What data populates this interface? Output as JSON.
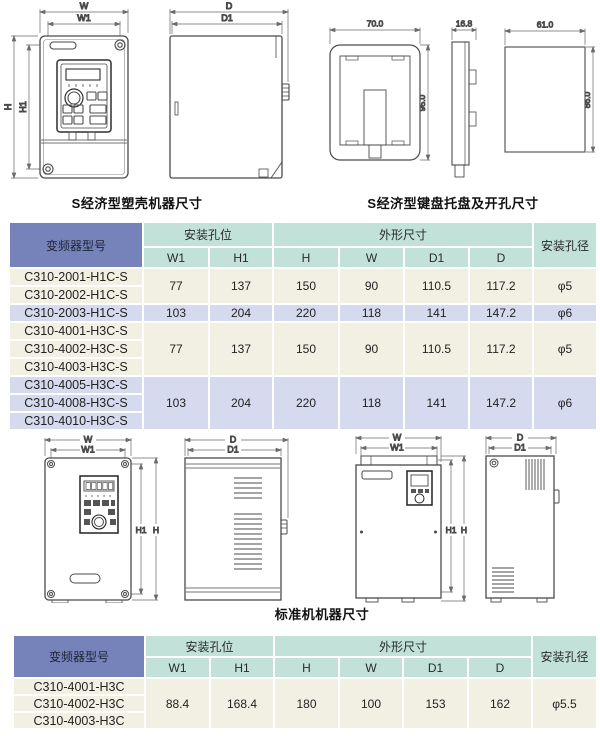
{
  "captions": {
    "top_left": "S经济型塑壳机器尺寸",
    "top_right": "S经济型键盘托盘及开孔尺寸",
    "middle": "标准机机器尺寸"
  },
  "dim_labels": {
    "w": "W",
    "w1": "W1",
    "h": "H",
    "h1": "H1",
    "d": "D",
    "d1": "D1"
  },
  "tray_dims": {
    "width": "70.0",
    "height": "95.0",
    "depth": "16.8",
    "cutout_width": "61.0",
    "cutout_height": "86.0"
  },
  "tables": {
    "headers": {
      "model": "变频器型号",
      "mount": "安装孔位",
      "outline": "外形尺寸",
      "hole": "安装孔径",
      "sub": [
        "W1",
        "H1",
        "H",
        "W",
        "D1",
        "D"
      ]
    },
    "s_series": {
      "groups": [
        {
          "models": [
            "C310-2001-H1C-S",
            "C310-2002-H1C-S"
          ],
          "values": [
            "77",
            "137",
            "150",
            "90",
            "110.5",
            "117.2"
          ],
          "hole": "φ5"
        },
        {
          "models": [
            "C310-2003-H1C-S"
          ],
          "values": [
            "103",
            "204",
            "220",
            "118",
            "141",
            "147.2"
          ],
          "hole": "φ6"
        },
        {
          "models": [
            "C310-4001-H3C-S",
            "C310-4002-H3C-S",
            "C310-4003-H3C-S"
          ],
          "values": [
            "77",
            "137",
            "150",
            "90",
            "110.5",
            "117.2"
          ],
          "hole": "φ5"
        },
        {
          "models": [
            "C310-4005-H3C-S",
            "C310-4008-H3C-S",
            "C310-4010-H3C-S"
          ],
          "values": [
            "103",
            "204",
            "220",
            "118",
            "141",
            "147.2"
          ],
          "hole": "φ6"
        }
      ]
    },
    "standard": {
      "groups": [
        {
          "models": [
            "C310-4001-H3C",
            "C310-4002-H3C",
            "C310-4003-H3C"
          ],
          "values": [
            "88.4",
            "168.4",
            "180",
            "100",
            "153",
            "162"
          ],
          "hole": "φ5.5"
        }
      ]
    }
  },
  "colors": {
    "header_blue": "#7683bb",
    "header_teal": "#c2e1d9",
    "row_cream": "#f2f0e3",
    "row_lavender": "#d6daee"
  }
}
